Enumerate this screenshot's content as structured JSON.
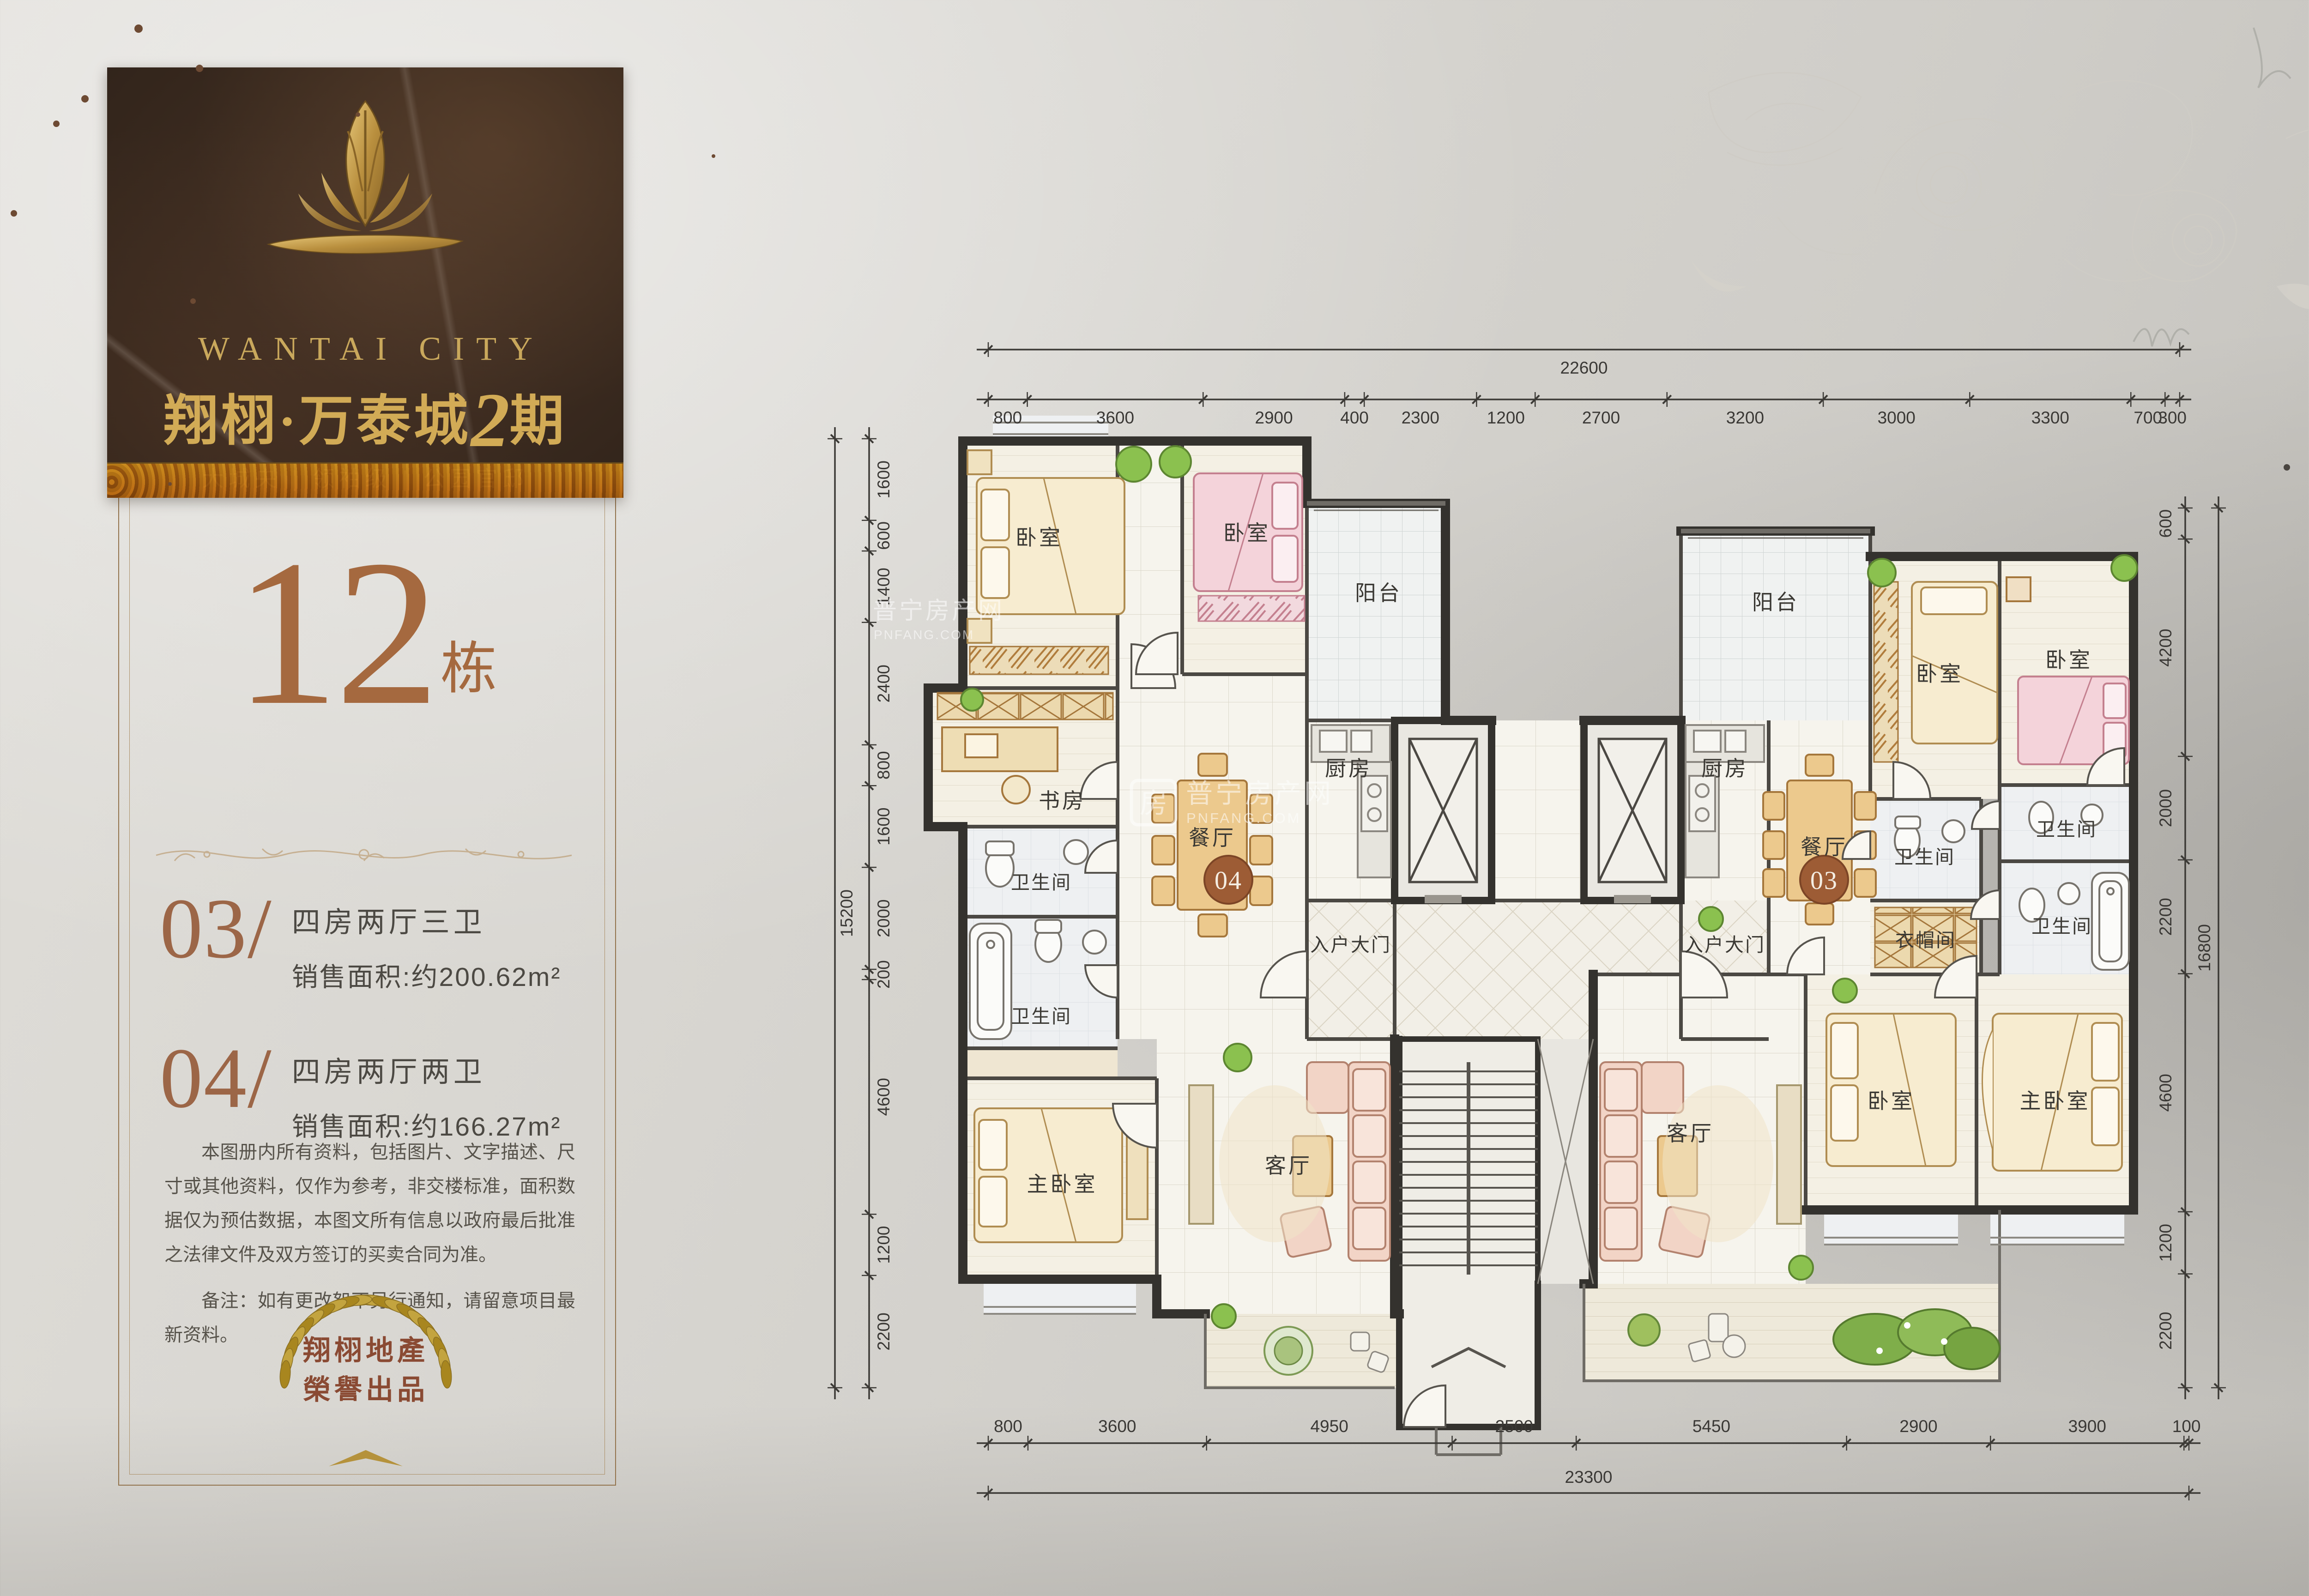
{
  "brand": {
    "title_en": "WANTAI CITY",
    "title_zh_pre": "翔栩·万泰城",
    "title_zh_num": "2",
    "title_zh_suf": "期",
    "tagline": "大城央 | 领袖级 | 公园官邸"
  },
  "building": {
    "number": "12",
    "suffix": "栋"
  },
  "units": [
    {
      "no": "03/",
      "type": "四房两厅三卫",
      "area": "销售面积:约200.62m²"
    },
    {
      "no": "04/",
      "type": "四房两厅两卫",
      "area": "销售面积:约166.27m²"
    }
  ],
  "disclaimer": {
    "body": "本图册内所有资料，包括图片、文字描述、尺寸或其他资料，仅作为参考，非交楼标准，面积数据仅为预估数据，本图文所有信息以政府最后批准之法律文件及双方签订的买卖合同为准。",
    "note": "备注：如有更改恕不另行通知，请留意项目最新资料。"
  },
  "seal": {
    "line1": "翔栩地產",
    "line2": "榮譽出品"
  },
  "plan": {
    "labels": {
      "bedroom": "卧室",
      "master_bedroom": "主卧室",
      "study": "书房",
      "dining": "餐厅",
      "living": "客厅",
      "kitchen": "厨房",
      "balcony": "阳台",
      "bath": "卫生间",
      "cloak": "衣帽间",
      "entrance": "入户大门",
      "unit04": "04",
      "unit03": "03"
    },
    "dims": {
      "top": {
        "total": "22600",
        "segments": [
          800,
          3600,
          2900,
          400,
          2300,
          1200,
          2700,
          3200,
          3000,
          3300,
          700,
          300
        ]
      },
      "bottom": {
        "total": "23300",
        "segments": [
          800,
          3600,
          4950,
          2500,
          5450,
          2900,
          3900,
          100
        ]
      },
      "left": {
        "total": "15200",
        "segments": [
          1600,
          600,
          1400,
          2400,
          800,
          1600,
          2000,
          200,
          4600,
          1200,
          2200
        ]
      },
      "right": {
        "total": "16800",
        "segments": [
          600,
          4200,
          2000,
          2200,
          4600,
          1200,
          2200
        ]
      }
    }
  },
  "watermark": {
    "logo_char": "房",
    "name": "普宁房产网",
    "domain": "PNFANG.COM"
  },
  "colors": {
    "gold": "#c9a85c",
    "bronze": "#a5693f",
    "badge": "#9d5c35",
    "wall": "#35332f",
    "paper": "#d6d4cf"
  }
}
